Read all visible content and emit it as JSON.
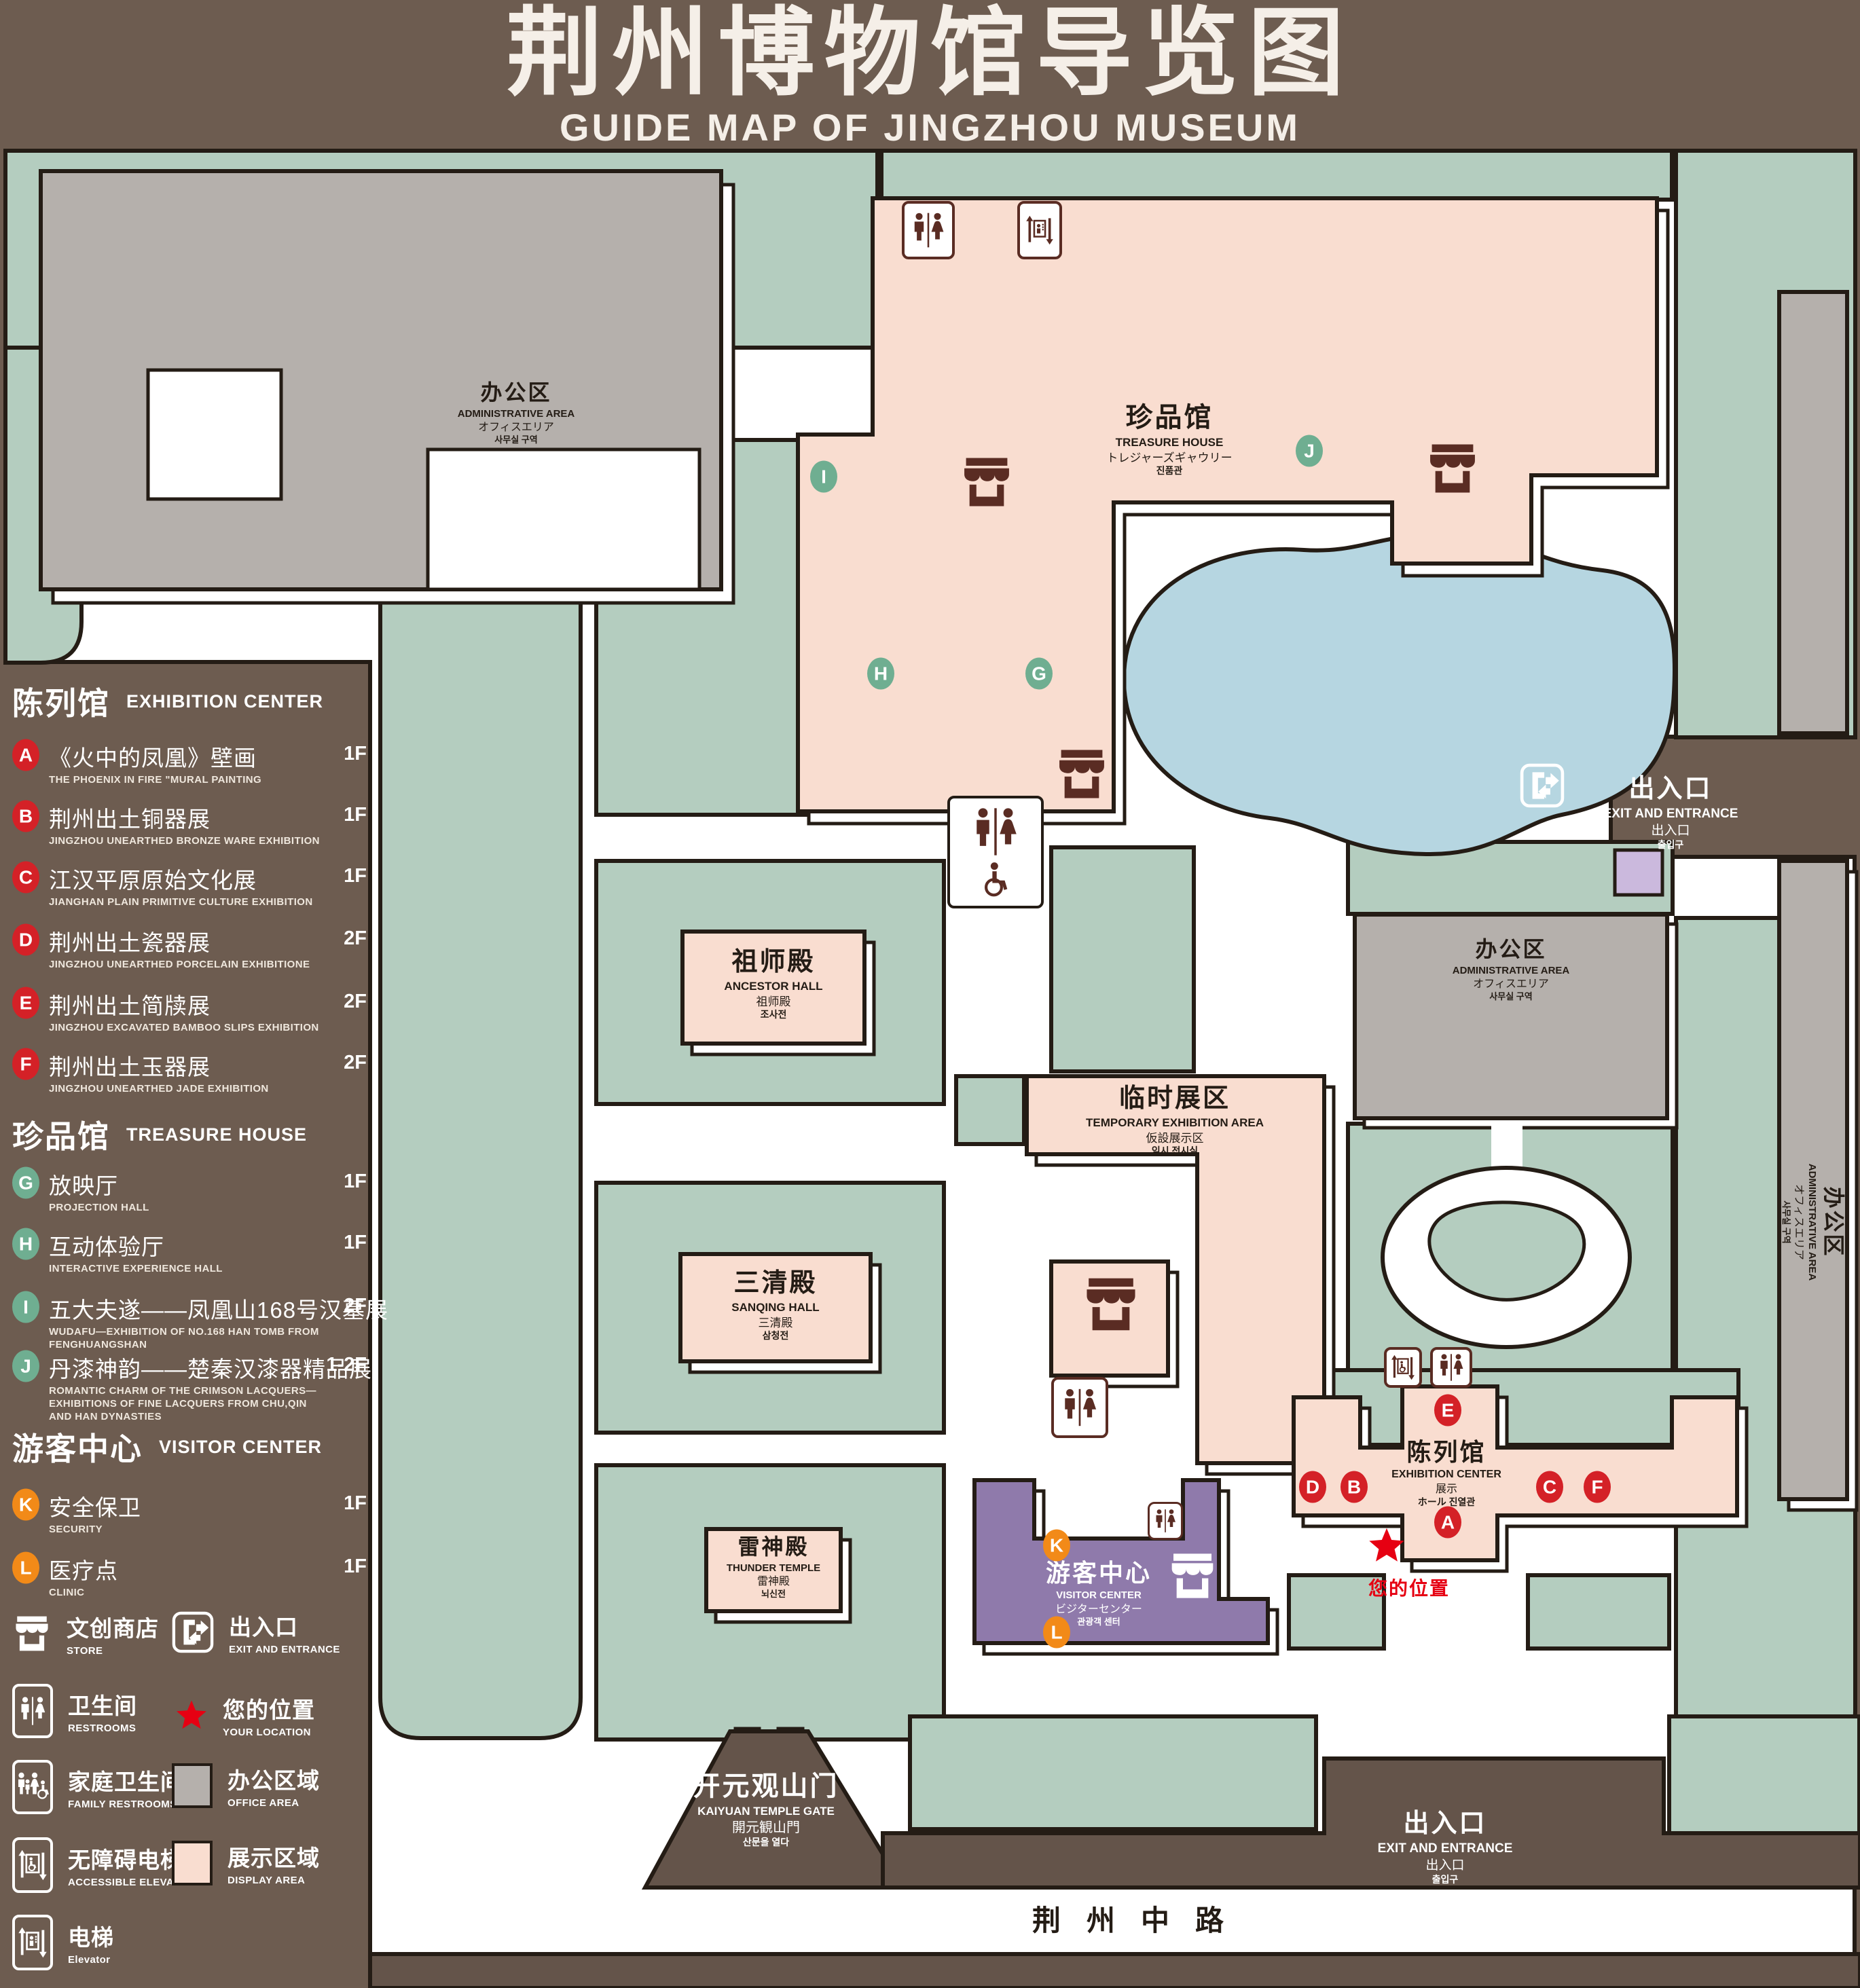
{
  "header": {
    "title_zh": "荆州博物馆导览图",
    "subtitle_en": "GUIDE MAP OF JINGZHOU MUSEUM"
  },
  "colors": {
    "background": "#6d5c50",
    "landscape_green": "#b4cdbf",
    "display_pink": "#f9ddd0",
    "office_gray": "#b5b0ac",
    "water_blue": "#b6d6e1",
    "visitor_purple": "#8f7aab",
    "light_purple": "#cbb9dd",
    "marker_red": "#d42127",
    "marker_green": "#6fae91",
    "marker_orange": "#f28a18",
    "icon_maroon": "#5a2c23",
    "location_red": "#e60012",
    "outline": "#241c15"
  },
  "legend": {
    "sections": [
      {
        "zh": "陈列馆",
        "en": "EXHIBITION CENTER"
      },
      {
        "zh": "珍品馆",
        "en": "TREASURE HOUSE"
      },
      {
        "zh": "游客中心",
        "en": "VISITOR CENTER"
      }
    ],
    "items": [
      {
        "code": "A",
        "zh": "《火中的凤凰》壁画",
        "en": "THE PHOENIX IN FIRE \"MURAL PAINTING",
        "floor": "1F"
      },
      {
        "code": "B",
        "zh": "荆州出土铜器展",
        "en": "JINGZHOU UNEARTHED BRONZE WARE EXHIBITION",
        "floor": "1F"
      },
      {
        "code": "C",
        "zh": "江汉平原原始文化展",
        "en": "JIANGHAN PLAIN PRIMITIVE CULTURE EXHIBITION",
        "floor": "1F"
      },
      {
        "code": "D",
        "zh": "荆州出土瓷器展",
        "en": "JINGZHOU UNEARTHED PORCELAIN EXHIBITIONE",
        "floor": "2F"
      },
      {
        "code": "E",
        "zh": "荆州出土简牍展",
        "en": "JINGZHOU EXCAVATED BAMBOO SLIPS EXHIBITION",
        "floor": "2F"
      },
      {
        "code": "F",
        "zh": "荆州出土玉器展",
        "en": "JINGZHOU UNEARTHED JADE EXHIBITION",
        "floor": "2F"
      },
      {
        "code": "G",
        "zh": "放映厅",
        "en": "PROJECTION HALL",
        "floor": "1F"
      },
      {
        "code": "H",
        "zh": "互动体验厅",
        "en": "INTERACTIVE EXPERIENCE HALL",
        "floor": "1F"
      },
      {
        "code": "I",
        "zh": "五大夫遂——凤凰山168号汉墓展",
        "en": "WUDAFU—EXHIBITION OF NO.168 HAN TOMB FROM FENGHUANGSHAN",
        "floor": "2F"
      },
      {
        "code": "J",
        "zh": "丹漆神韵——楚秦汉漆器精品展",
        "en": "ROMANTIC CHARM OF THE CRIMSON LACQUERS—EXHIBITIONS OF FINE LACQUERS FROM CHU,QIN AND HAN DYNASTIES",
        "floor": "1-2F"
      },
      {
        "code": "K",
        "zh": "安全保卫",
        "en": "SECURITY",
        "floor": "1F"
      },
      {
        "code": "L",
        "zh": "医疗点",
        "en": "CLINIC",
        "floor": "1F"
      }
    ],
    "symbols": {
      "store": {
        "zh": "文创商店",
        "en": "STORE"
      },
      "exit": {
        "zh": "出入口",
        "en": "EXIT AND ENTRANCE"
      },
      "restrooms": {
        "zh": "卫生间",
        "en": "RESTROOMS"
      },
      "location": {
        "zh": "您的位置",
        "en": "YOUR LOCATION"
      },
      "family": {
        "zh": "家庭卫生间",
        "en": "FAMILY RESTROOMS"
      },
      "office": {
        "zh": "办公区域",
        "en": "OFFICE AREA"
      },
      "accessible": {
        "zh": "无障碍电梯",
        "en": "ACCESSIBLE ELEVATOR"
      },
      "display": {
        "zh": "展示区域",
        "en": "DISPLAY AREA"
      },
      "elevator": {
        "zh": "电梯",
        "en": "Elevator"
      }
    }
  },
  "map": {
    "office": {
      "zh": "办公区",
      "en": "ADMINISTRATIVE AREA",
      "ja": "オフィスエリア",
      "ko": "사무실 구역"
    },
    "treasure": {
      "zh": "珍品馆",
      "en": "TREASURE HOUSE",
      "ja": "トレジャーズギャウリー",
      "ko": "진품관"
    },
    "ancestor": {
      "zh": "祖师殿",
      "en": "ANCESTOR HALL",
      "ja": "祖师殿",
      "ko": "조사전"
    },
    "temp": {
      "zh": "临时展区",
      "en": "TEMPORARY EXHIBITION AREA",
      "ja": "仮設展示区",
      "ko": "임시 전시실"
    },
    "sanqing": {
      "zh": "三清殿",
      "en": "SANQING HALL",
      "ja": "三清殿",
      "ko": "삼청전"
    },
    "thunder": {
      "zh": "雷神殿",
      "en": "THUNDER TEMPLE",
      "ja": "雷神殿",
      "ko": "뇌신전"
    },
    "visitor": {
      "zh": "游客中心",
      "en": "VISITOR CENTER",
      "ja": "ビジターセンター",
      "ko": "관광객 센터"
    },
    "exhibition": {
      "zh": "陈列馆",
      "en": "EXHIBITION CENTER",
      "ja": "展示",
      "ja2": "ホール",
      "ko": "진열관"
    },
    "exit": {
      "zh": "出入口",
      "en": "EXIT AND ENTRANCE",
      "ja": "出入口",
      "ko": "출입구"
    },
    "gate": {
      "zh": "开元观山门",
      "en": "KAIYUAN TEMPLE GATE",
      "ja": "開元観山門",
      "ko": "산문을 열다"
    },
    "road": {
      "zh": "荆州中路"
    },
    "your_location": "您的位置",
    "markers": {
      "a": "A",
      "b": "B",
      "c": "C",
      "d": "D",
      "e": "E",
      "f": "F",
      "g": "G",
      "h": "H",
      "i": "I",
      "j": "J",
      "k": "K",
      "l": "L"
    }
  }
}
